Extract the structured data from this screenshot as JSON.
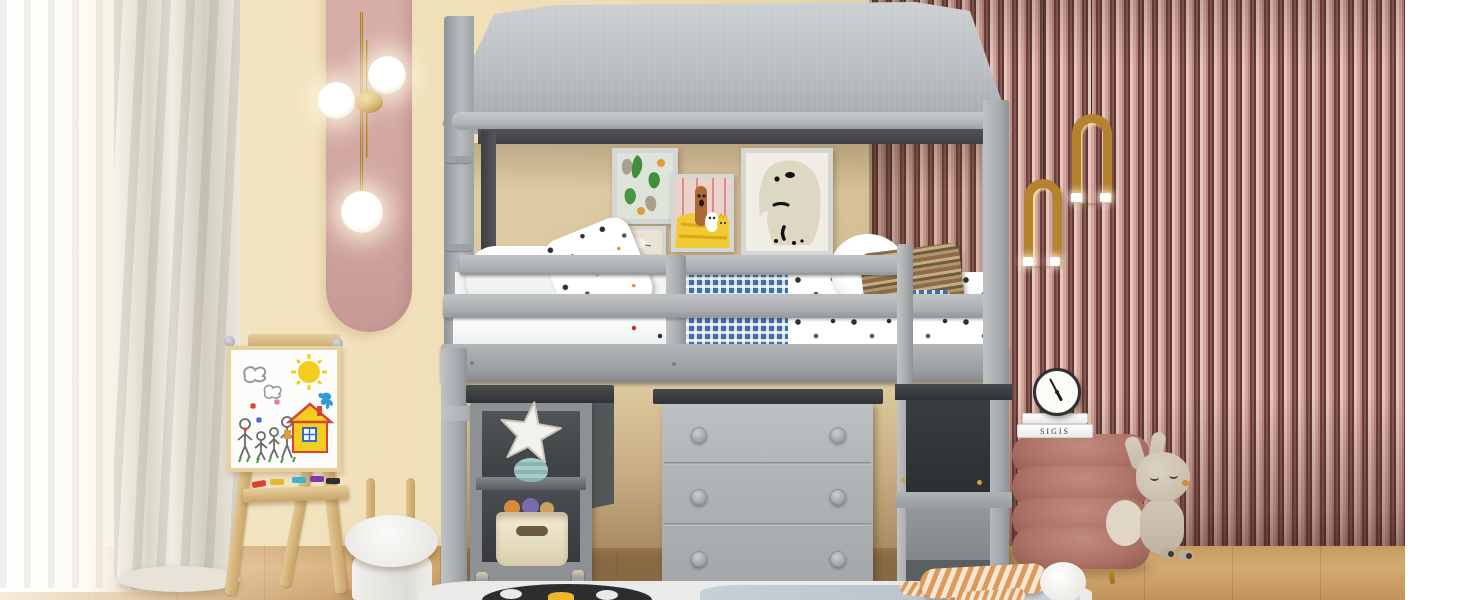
{
  "scene": {
    "description": "Product photo of a gray kids house-frame loft bed with canopy roof in a children's bedroom; under the loft: a rolling shelf cart with starfish decor and storage basket, a gray 3-drawer dresser, and an integrated ladder with storage steps.",
    "room": {
      "left_wall": "cream",
      "right_wall": "mauve vertical slat panels",
      "floor": "light oak wood",
      "accents": [
        "pink oval wall panel",
        "white sheer curtains",
        "ivory drape"
      ]
    }
  },
  "palette": {
    "cream_wall": "#f2e2bd",
    "slat_dark": "#6b403d",
    "slat_light": "#e9c6bd",
    "bed_gray": "#b3b6b8",
    "dark_slab_gray": "#3a3d40",
    "floor_wood": "#cb9f66",
    "pink_panel": "#d2a7a2",
    "brass_gold": "#b5832e",
    "pouf_mauve": "#ab7065",
    "gingham_blue": "#3f6fa5",
    "rug_white": "#eaeae8"
  },
  "decor": {
    "book_spine_text": "SIGIS",
    "clock_time": "10:25",
    "wall_art": [
      "abstract green blobs",
      "small animal sketch",
      "bear with dog and cat on yellow",
      "polar bear"
    ],
    "plush_toys": [
      "moon pillow",
      "bunny plush",
      "striped doll"
    ],
    "easel_drawing": "sun, clouds, house and family in crayon"
  }
}
